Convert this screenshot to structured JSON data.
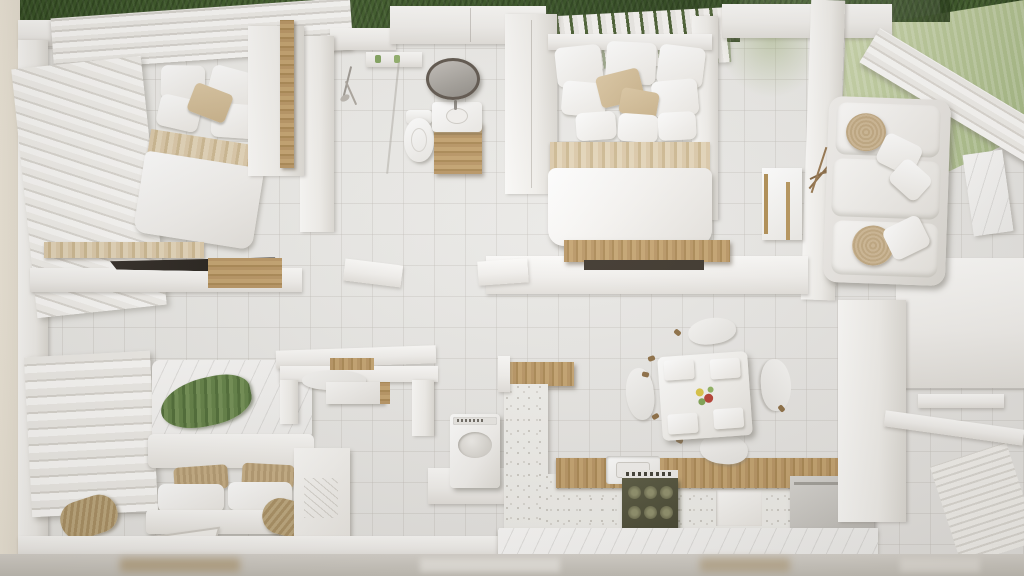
{
  "scene": {
    "title": "Top-down 3D dollhouse render of a small apartment",
    "view": "bird's-eye cutaway with lawn along the top and right edges",
    "visible_text": "none"
  },
  "palette": {
    "floor_tile": "#eceae7",
    "wall_white": "#f4f2ee",
    "wood": "#b6925f",
    "wood_light": "#d9c7a6",
    "grass_dark": "#35511f",
    "grass_light": "#bcc99a",
    "stove_front": "#4e4e36",
    "mirror_rim": "#5a5148",
    "throw_green": "#5f7e42",
    "centerpiece_red": "#b53a2e",
    "terrazzo": "#efeeea"
  },
  "rooms": [
    {
      "id": "bedroom-top-left",
      "label": "Bedroom 1",
      "furniture": [
        "double bed with white duvet, beige accent pillows and wood trim band",
        "slatted louver wardrobe wall",
        "wood shelf",
        "desk with dark top",
        "tall wood door panel"
      ]
    },
    {
      "id": "bathroom",
      "label": "Bathroom",
      "furniture": [
        "shower set",
        "shelf niche with two green bottles",
        "toilet",
        "vanity with wood cabinet",
        "round mirror with dark rim"
      ]
    },
    {
      "id": "bedroom-master",
      "label": "Master Bedroom",
      "furniture": [
        "double bed with layered white pillows, beige cushions and marble-beige runner",
        "wardrobe panels",
        "wood bench at foot of bed"
      ]
    },
    {
      "id": "living-room",
      "label": "Living Room",
      "furniture": [
        "white fabric sofa",
        "two round rattan cushions",
        "white throw pillows",
        "console table with brass legs",
        "dried branch decor",
        "marble accent rug"
      ]
    },
    {
      "id": "bedroom-bottom-left",
      "label": "Bedroom 2",
      "furniture": [
        "bed with green throw blanket and marble-white duvet",
        "accordion louver closet doors",
        "two rattan bolster cushions",
        "woven pillows",
        "white bench",
        "patterned rug",
        "white sideboard"
      ]
    },
    {
      "id": "study-nook",
      "label": "Study Nook",
      "furniture": [
        "wall desk with wood inlay",
        "tucked-in chair",
        "drawer unit"
      ]
    },
    {
      "id": "laundry",
      "label": "Laundry Corner",
      "furniture": [
        "top-load washing machine on white platform"
      ]
    },
    {
      "id": "kitchen",
      "label": "Kitchen",
      "furniture": [
        "terrazzo partition with wood cap",
        "wood countertop",
        "inset sink",
        "dark gas range with six knobs",
        "white cabinet door",
        "marble plinth",
        "steel low cabinet"
      ]
    },
    {
      "id": "dining",
      "label": "Dining Area",
      "furniture": [
        "square table with white place settings",
        "red-green flower centerpiece",
        "four white chairs with wood leg tips"
      ]
    }
  ]
}
